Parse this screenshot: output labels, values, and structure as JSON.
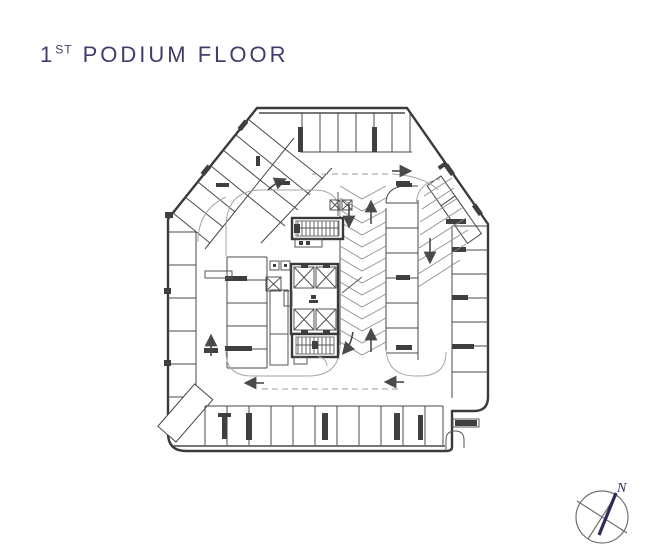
{
  "title": {
    "number": "1",
    "ordinal": "ST",
    "rest": "PODIUM FLOOR",
    "color": "#413d6b"
  },
  "compass": {
    "label": "N",
    "needle_color": "#2f2a58",
    "ring_color": "#6f6f6f"
  },
  "plan": {
    "kind": "podium parking floor plan",
    "ink_color": "#3a3a3a",
    "light_line_color": "#a6a6a6",
    "background": "#ffffff"
  }
}
